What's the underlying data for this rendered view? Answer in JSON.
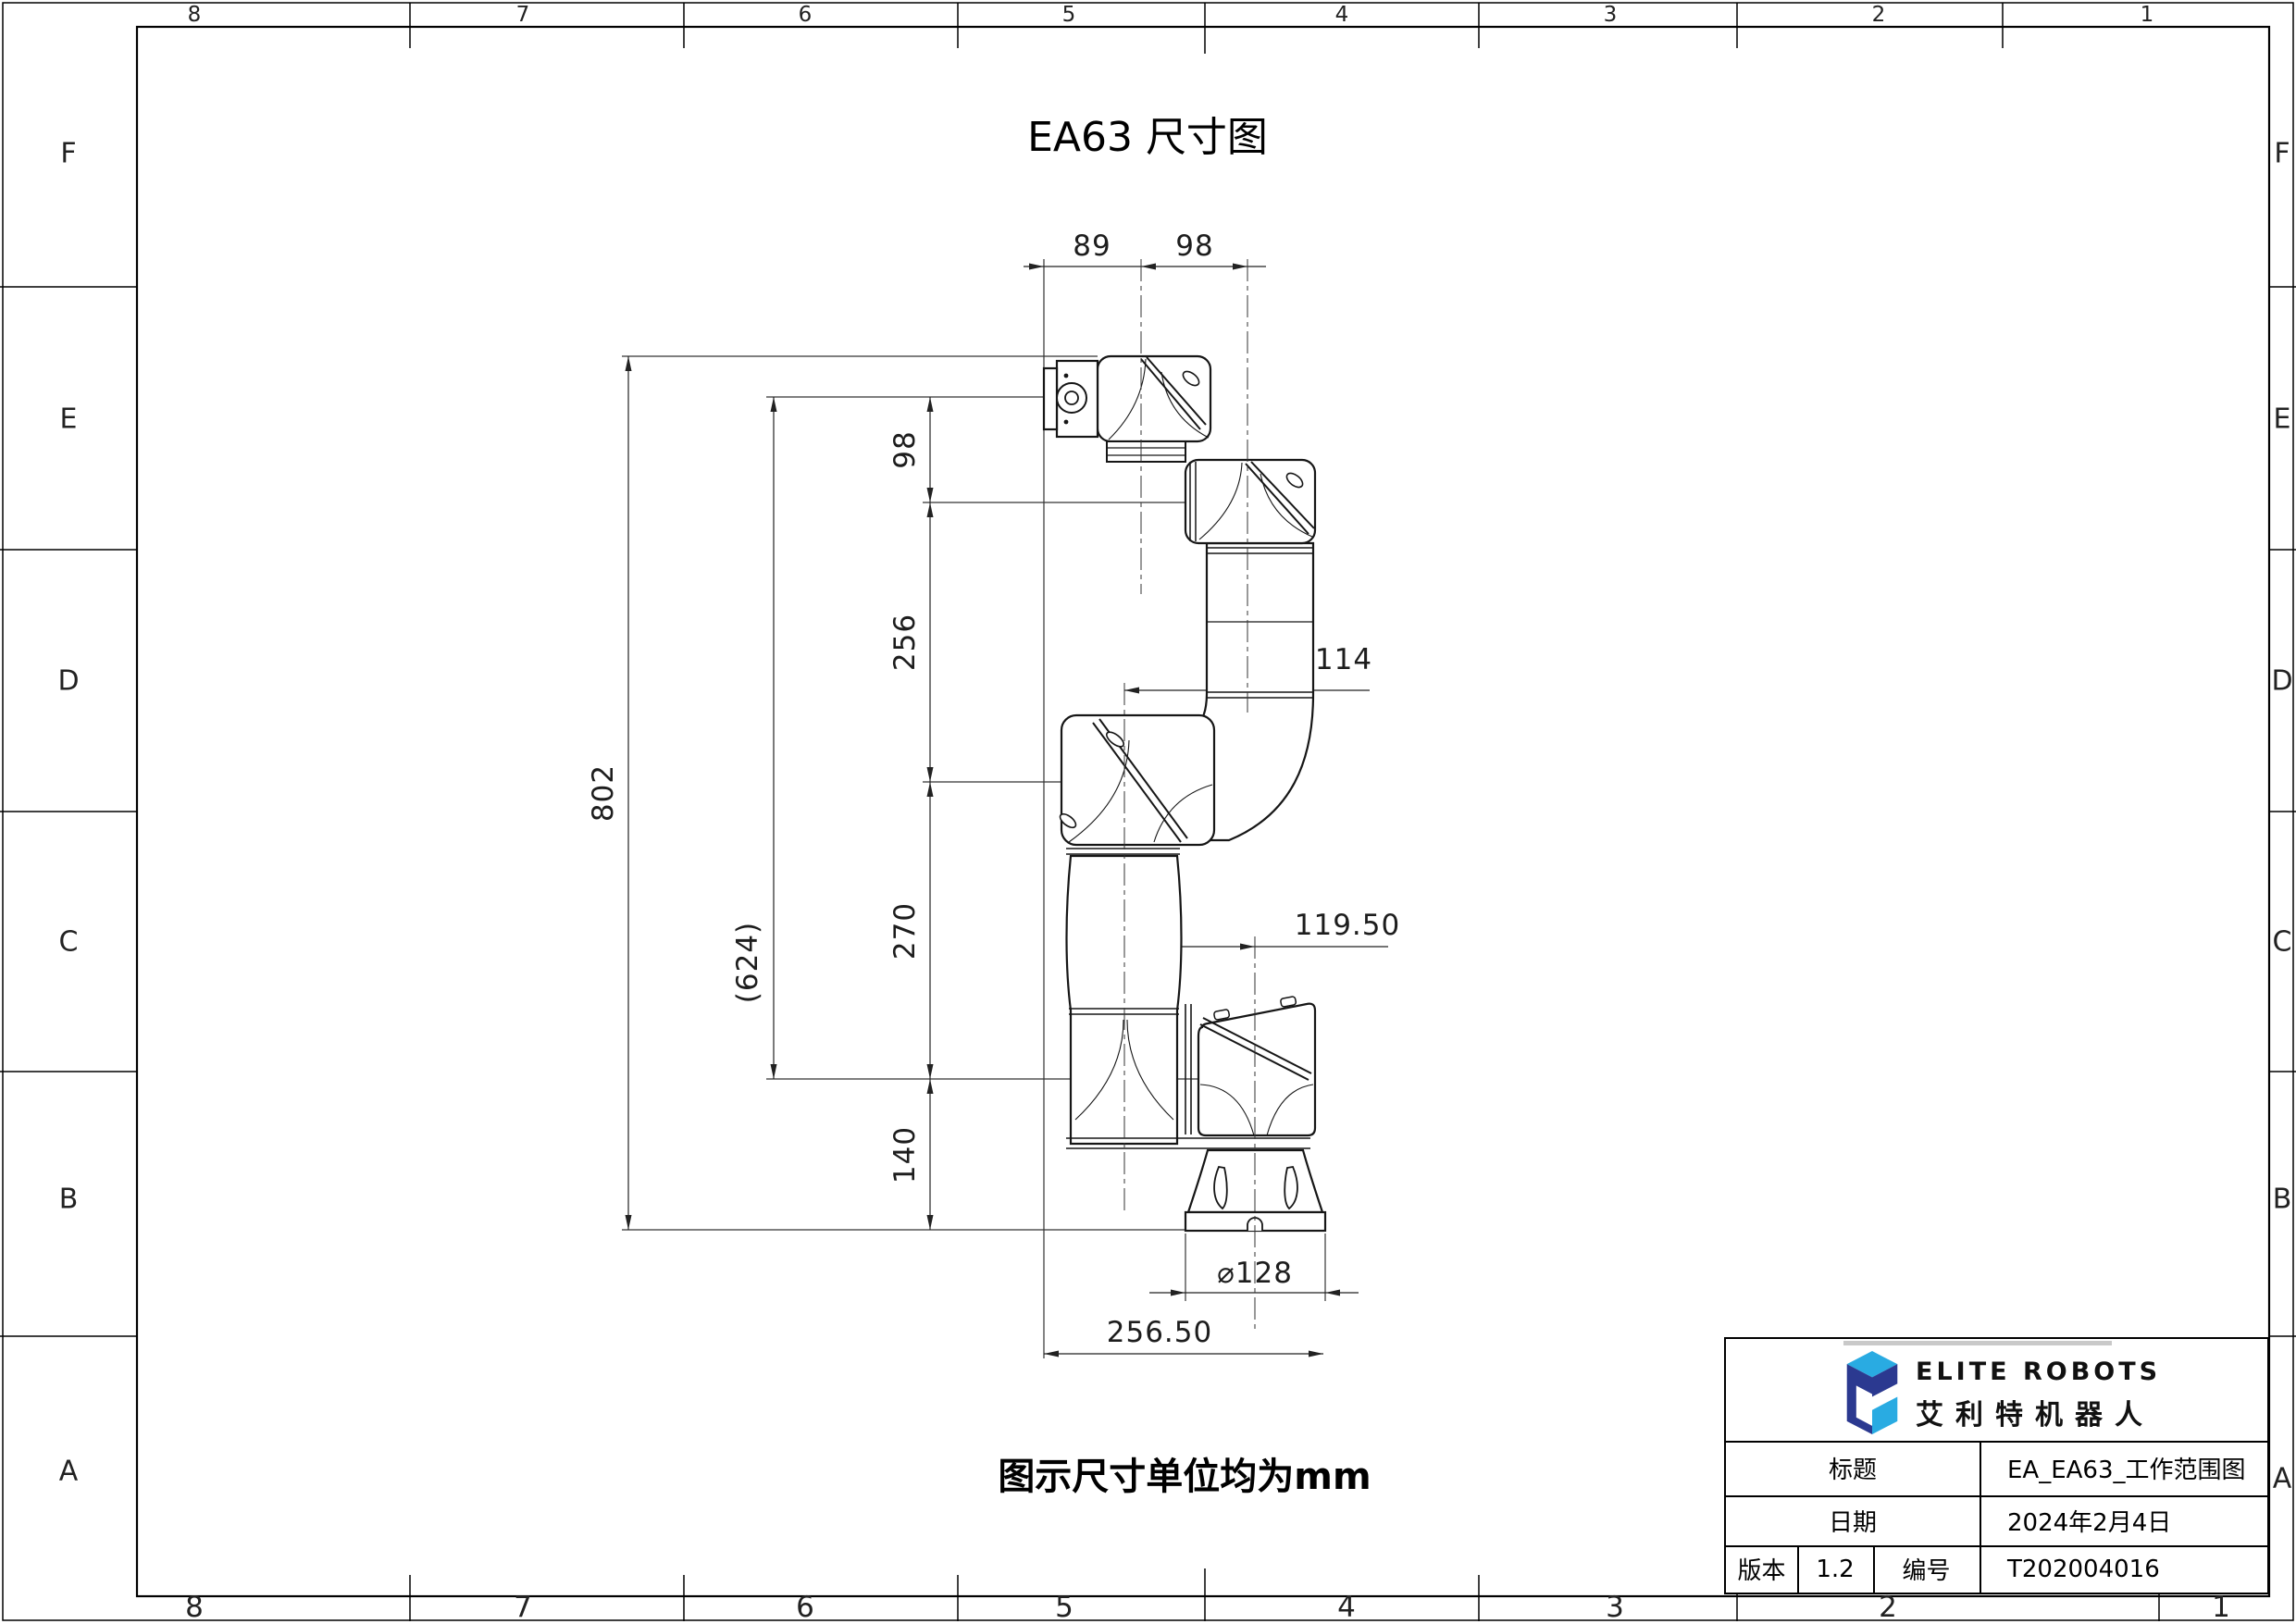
{
  "sheet": {
    "title": "EA63 尺寸图",
    "note": "图示尺寸单位均为mm",
    "top_zones": [
      "8",
      "7",
      "6",
      "5",
      "4",
      "3",
      "2",
      "1"
    ],
    "bottom_zones": [
      "8",
      "7",
      "6",
      "5",
      "4",
      "3",
      "2",
      "1"
    ],
    "side_letters": [
      "F",
      "E",
      "D",
      "C",
      "B",
      "A"
    ]
  },
  "dims": {
    "w89": "89",
    "w98": "98",
    "h98": "98",
    "h256": "256",
    "h270": "270",
    "h140": "140",
    "h802": "802",
    "h624": "(624)",
    "off114": "114",
    "off11950": "119.50",
    "dia128": "⌀128",
    "base_w": "256.50"
  },
  "title_block": {
    "brand_en": "ELITE ROBOTS",
    "brand_cn": "艾利特机器人",
    "row_title_label": "标题",
    "row_title_value": "EA_EA63_工作范围图",
    "row_date_label": "日期",
    "row_date_value": "2024年2月4日",
    "row_ver_label": "版本",
    "row_ver_value": "1.2",
    "row_no_label": "编号",
    "row_no_value": "T202004016"
  },
  "colors": {
    "logo_dark": "#2b3990",
    "logo_light": "#29abe2",
    "ink": "#1a1a1a",
    "gray_bar": "#c9c9c9"
  }
}
